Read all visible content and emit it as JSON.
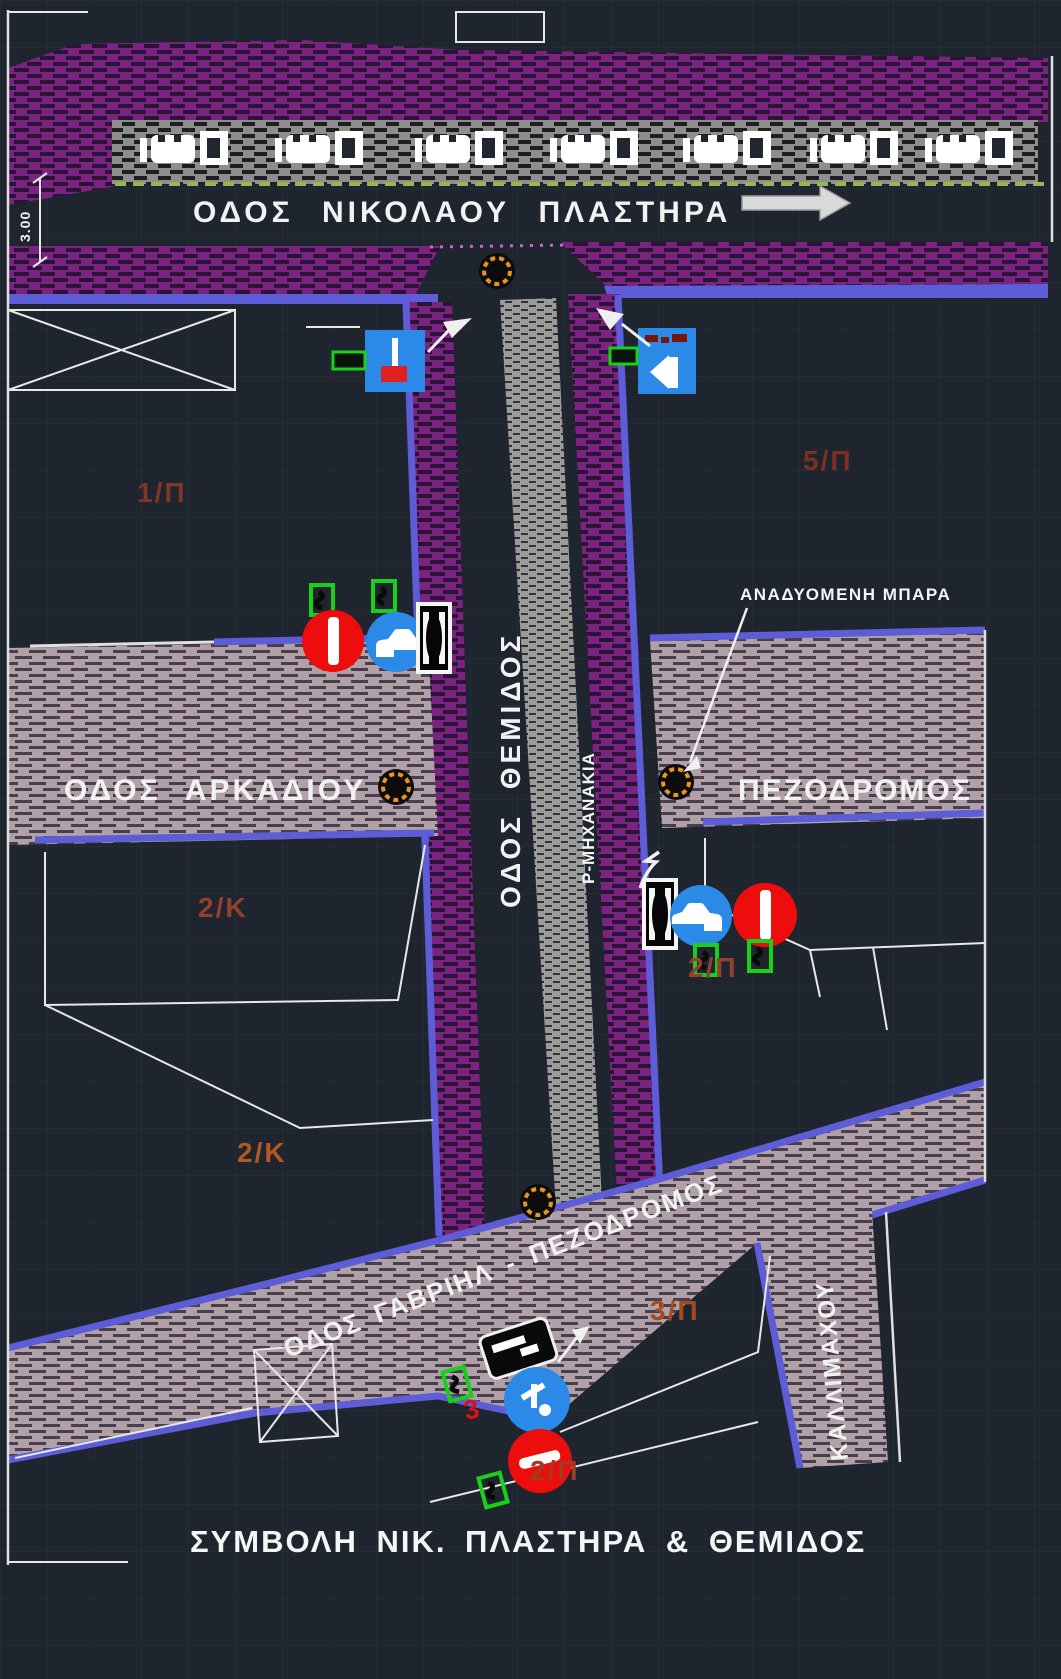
{
  "title": "ΣΥΜΒΟΛΗ ΝΙΚ. ΠΛΑΣΤΗΡΑ & ΘΕΜΙΔΟΣ",
  "streets": {
    "nikolaou_plastira": "ΟΔΟΣ ΝΙΚΟΛΑΟΥ ΠΛΑΣΤΗΡΑ",
    "arkadiou": "ΟΔΟΣ ΑΡΚΑΔΙΟΥ",
    "themidos": "ΟΔΟΣ ΘΕΜΙΔΟΣ",
    "pezodromos": "ΠΕΖΟΔΡΟΜΟΣ",
    "gavriil": "ΟΔΟΣ ΓΑΒΡΙΗΛ - ΠΕΖΟΔΡΟΜΟΣ",
    "kallimachou": "ΚΑΛΛΙΜΑΧΟΥ"
  },
  "labels": {
    "moto_parking": "Ρ-ΜΗΧΑΝΑΚΙΑ",
    "rising_bollard": "ΑΝΑΔΥΟΜΕΝΗ ΜΠΑΡΑ",
    "dimension": "3.00",
    "sign_number": "3"
  },
  "zones": [
    {
      "text": "1/Π"
    },
    {
      "text": "5/Π"
    },
    {
      "text": "2/Κ"
    },
    {
      "text": "2/Π"
    },
    {
      "text": "2/Κ"
    },
    {
      "text": "3/Π"
    },
    {
      "text": "2/Π"
    }
  ],
  "colors": {
    "background": "#1f252e",
    "sidewalk_hatch_purple": "#7a2380",
    "pedestrian_hatch_pink": "#b2a0a8",
    "parking_hatch_gray": "#8e8e8e",
    "road_edge_blue": "#5d5dd8",
    "sign_blue": "#2b8ae8",
    "sign_red": "#ee0d0d",
    "bracket_green": "#19cf19",
    "bollard_orange": "#e8961e",
    "lane_line_green": "#92b84e",
    "zone_label_brown": "#9a4128"
  }
}
